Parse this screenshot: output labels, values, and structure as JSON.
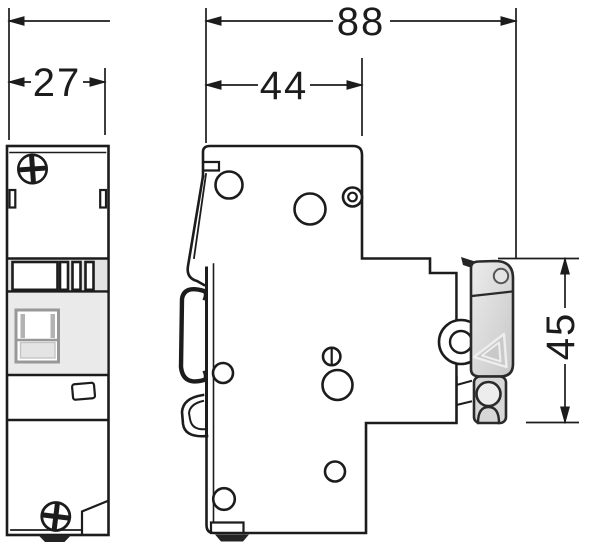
{
  "title": "modular-device-dimension-drawing",
  "dimensions": {
    "front_width": "27",
    "side_total_depth": "88",
    "side_body_depth": "44",
    "side_rail_height": "45"
  },
  "colors": {
    "line": "#1c1c1c",
    "label_area_gray": "#eaeaea",
    "terminal_band_gray": "#e3e3e3",
    "latch_gray": "#d2d2d2",
    "clip_gray": "#d7d7d7",
    "window_frame_gray": "#989898",
    "background": "#ffffff"
  }
}
